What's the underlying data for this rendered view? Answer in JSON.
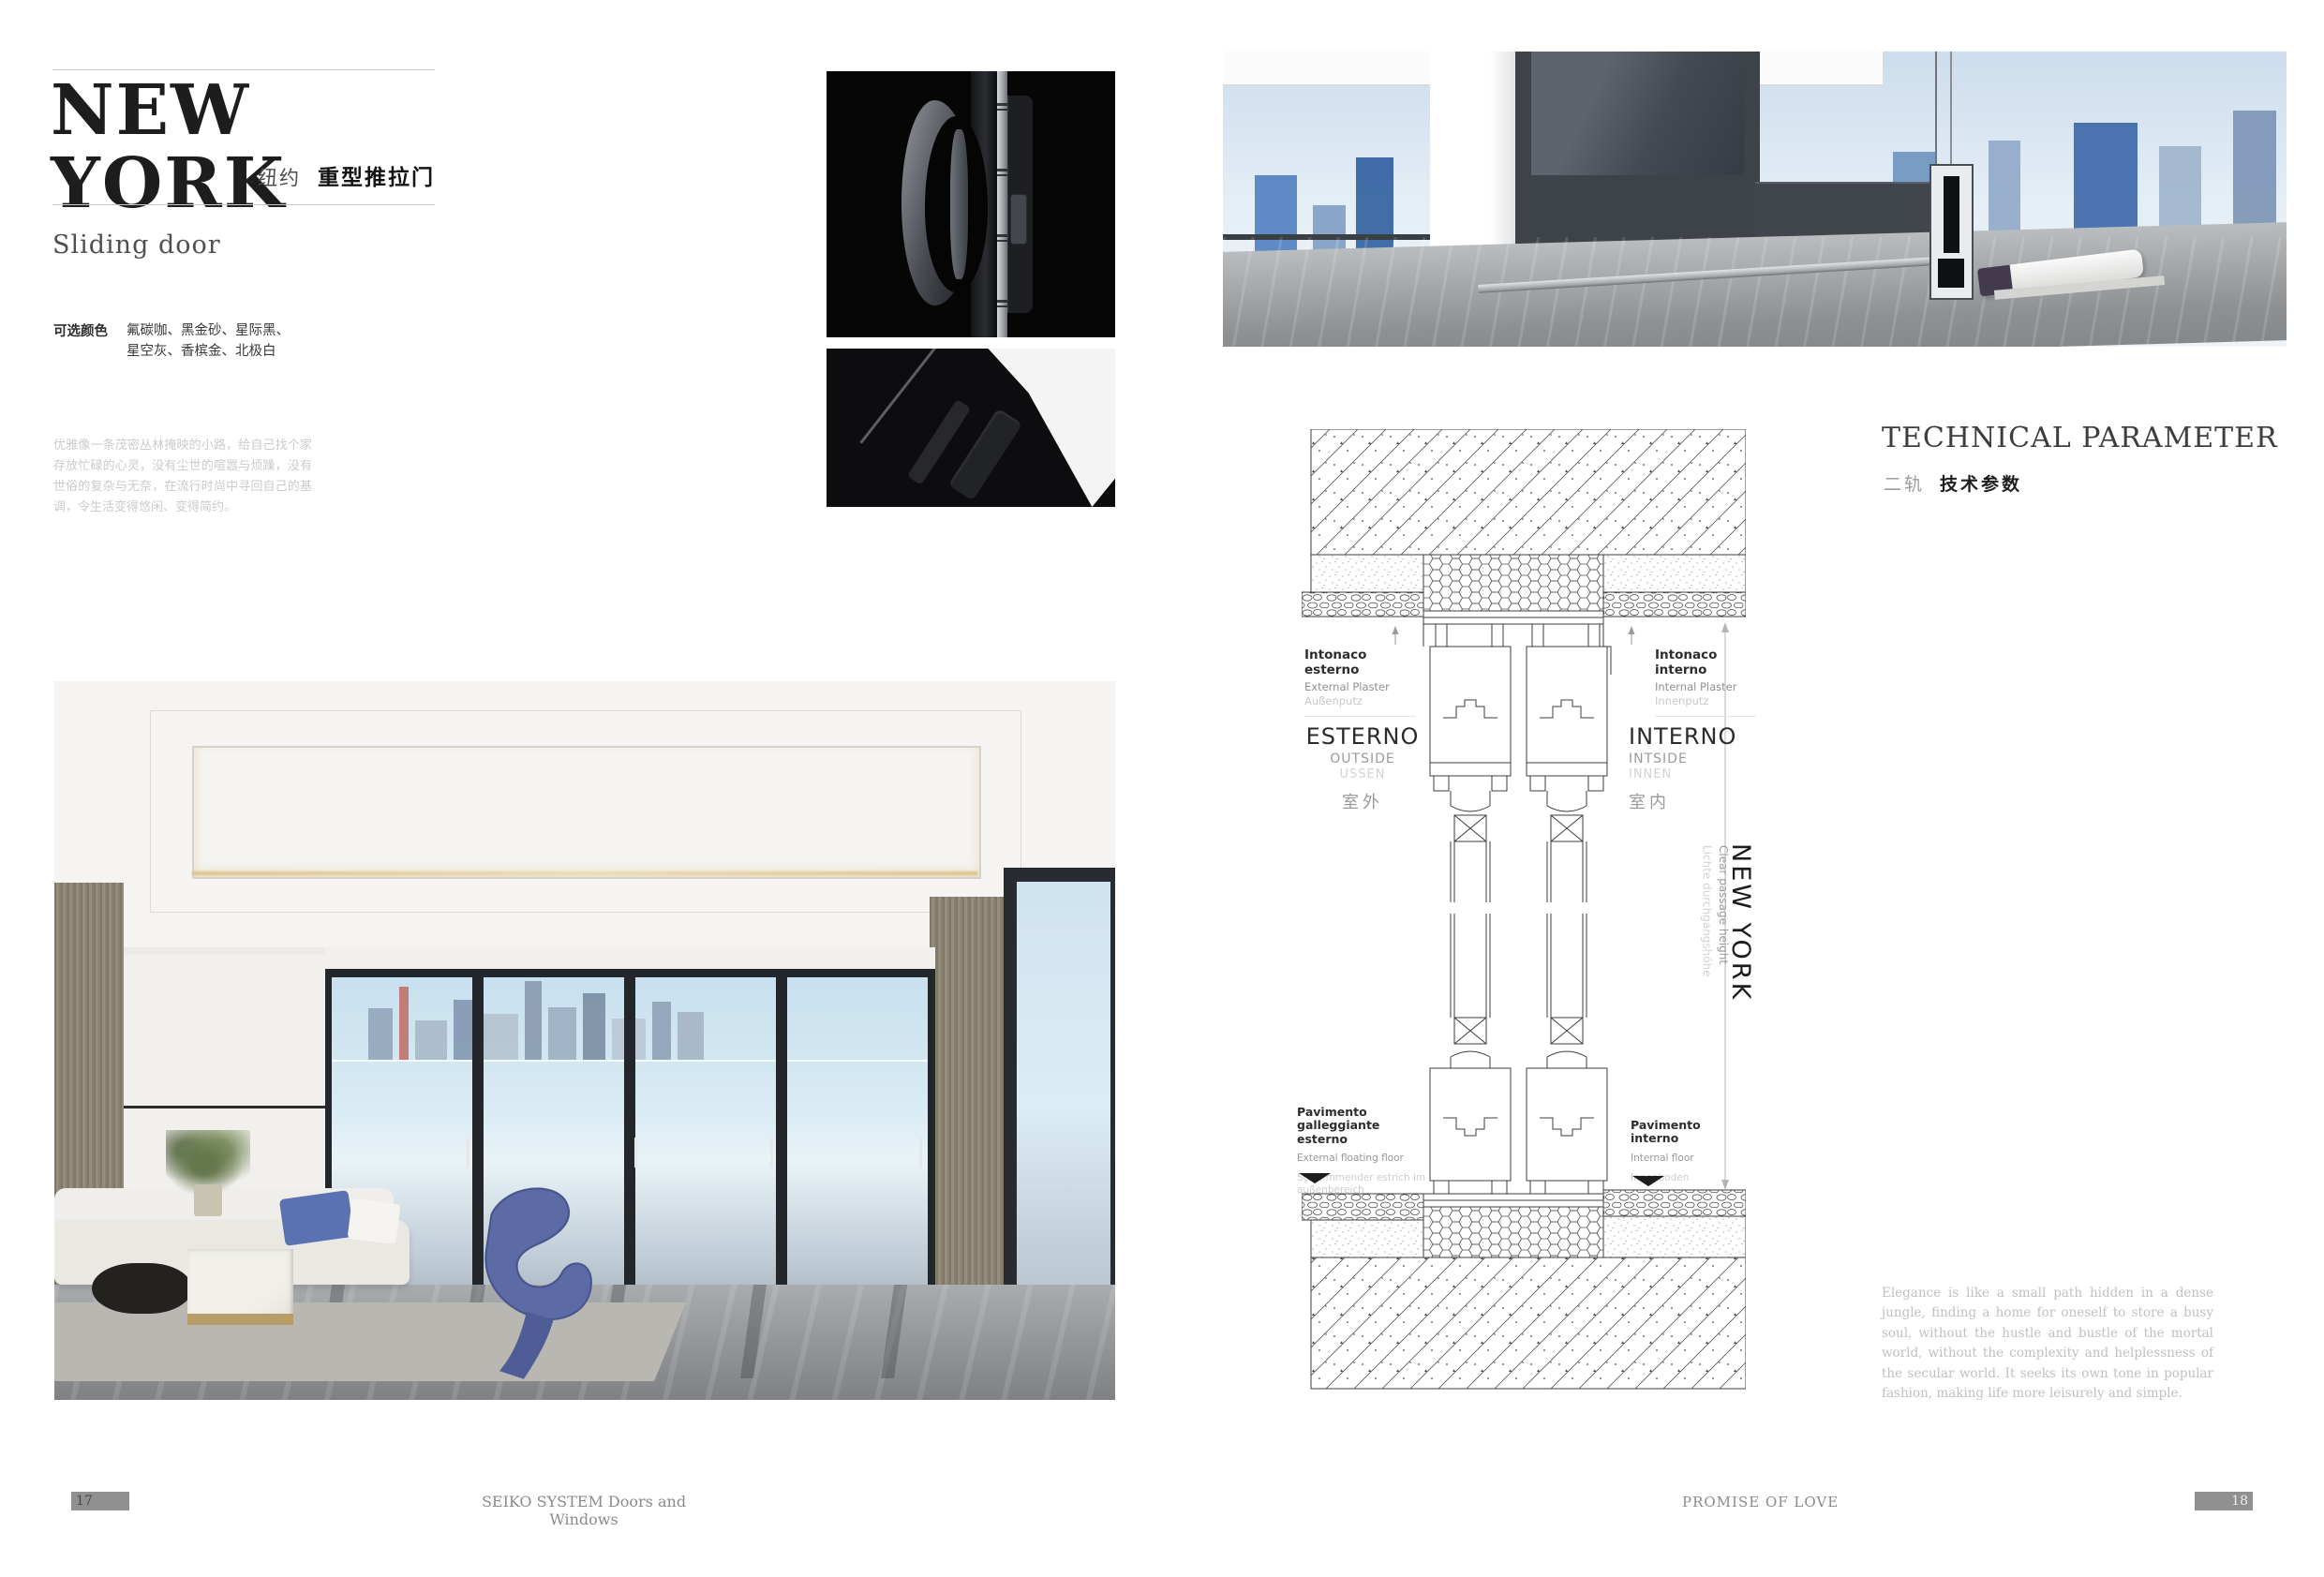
{
  "left_page": {
    "title": "NEW YORK",
    "subtitle_cn": "纽约",
    "subtitle_cn_bold": "重型推拉门",
    "product_type": "Sliding door",
    "colors_label": "可选颜色",
    "colors_line1": "氟碳咖、黑金砂、星际黑、",
    "colors_line2": "星空灰、香槟金、北极白",
    "description_cn": "优雅像一条茂密丛林掩映的小路，给自己找个家存放忙碌的心灵，没有尘世的喧嚣与烦躁，没有世俗的复杂与无奈，在流行时尚中寻回自己的基调，令生活变得悠闲、变得简约。"
  },
  "right_page": {
    "section_title": "TECHNICAL PARAMETER",
    "section_sub_light": "二轨",
    "section_sub_bold": "技术参数",
    "description_en": "Elegance is like a small path hidden in a dense jungle, finding a home for oneself to store a busy soul, without the hustle and bustle of the mortal world, without the complexity and helplessness of the secular world. It seeks its own tone in popular fashion, making life more leisurely and simple."
  },
  "diagram": {
    "plaster_ext": [
      "Intonaco esterno",
      "External Plaster",
      "Außenputz"
    ],
    "plaster_int": [
      "Intonaco interno",
      "Internal Plaster",
      "Innenputz"
    ],
    "side_ext": [
      "ESTERNO",
      "OUTSIDE",
      "USSEN",
      "室外"
    ],
    "side_int": [
      "INTERNO",
      "INTSIDE",
      "INNEN",
      "室内"
    ],
    "floor_ext": [
      "Pavimento galleggiante esterno",
      "External floating floor",
      "Schwimmender estrich im außenbereich"
    ],
    "floor_int": [
      "Pavimento interno",
      "Internal floor",
      "Innenboden"
    ],
    "dim_label_en": "Clear passage height",
    "dim_label_de": "Lichte durchgangshöhe",
    "brand_vertical": "NEW YORK"
  },
  "footer": {
    "page_left": "17",
    "brand": "SEIKO SYSTEM Doors and Windows",
    "slogan": "PROMISE OF LOVE",
    "page_right": "18"
  },
  "colors": {
    "accent_chair_blue": "#5c6ba6",
    "pillow_blue": "#5a72b2",
    "door_frame_dark": "#23272c",
    "light_gray_text": "#cbcbcb",
    "footer_gray": "#8a8a8a"
  }
}
